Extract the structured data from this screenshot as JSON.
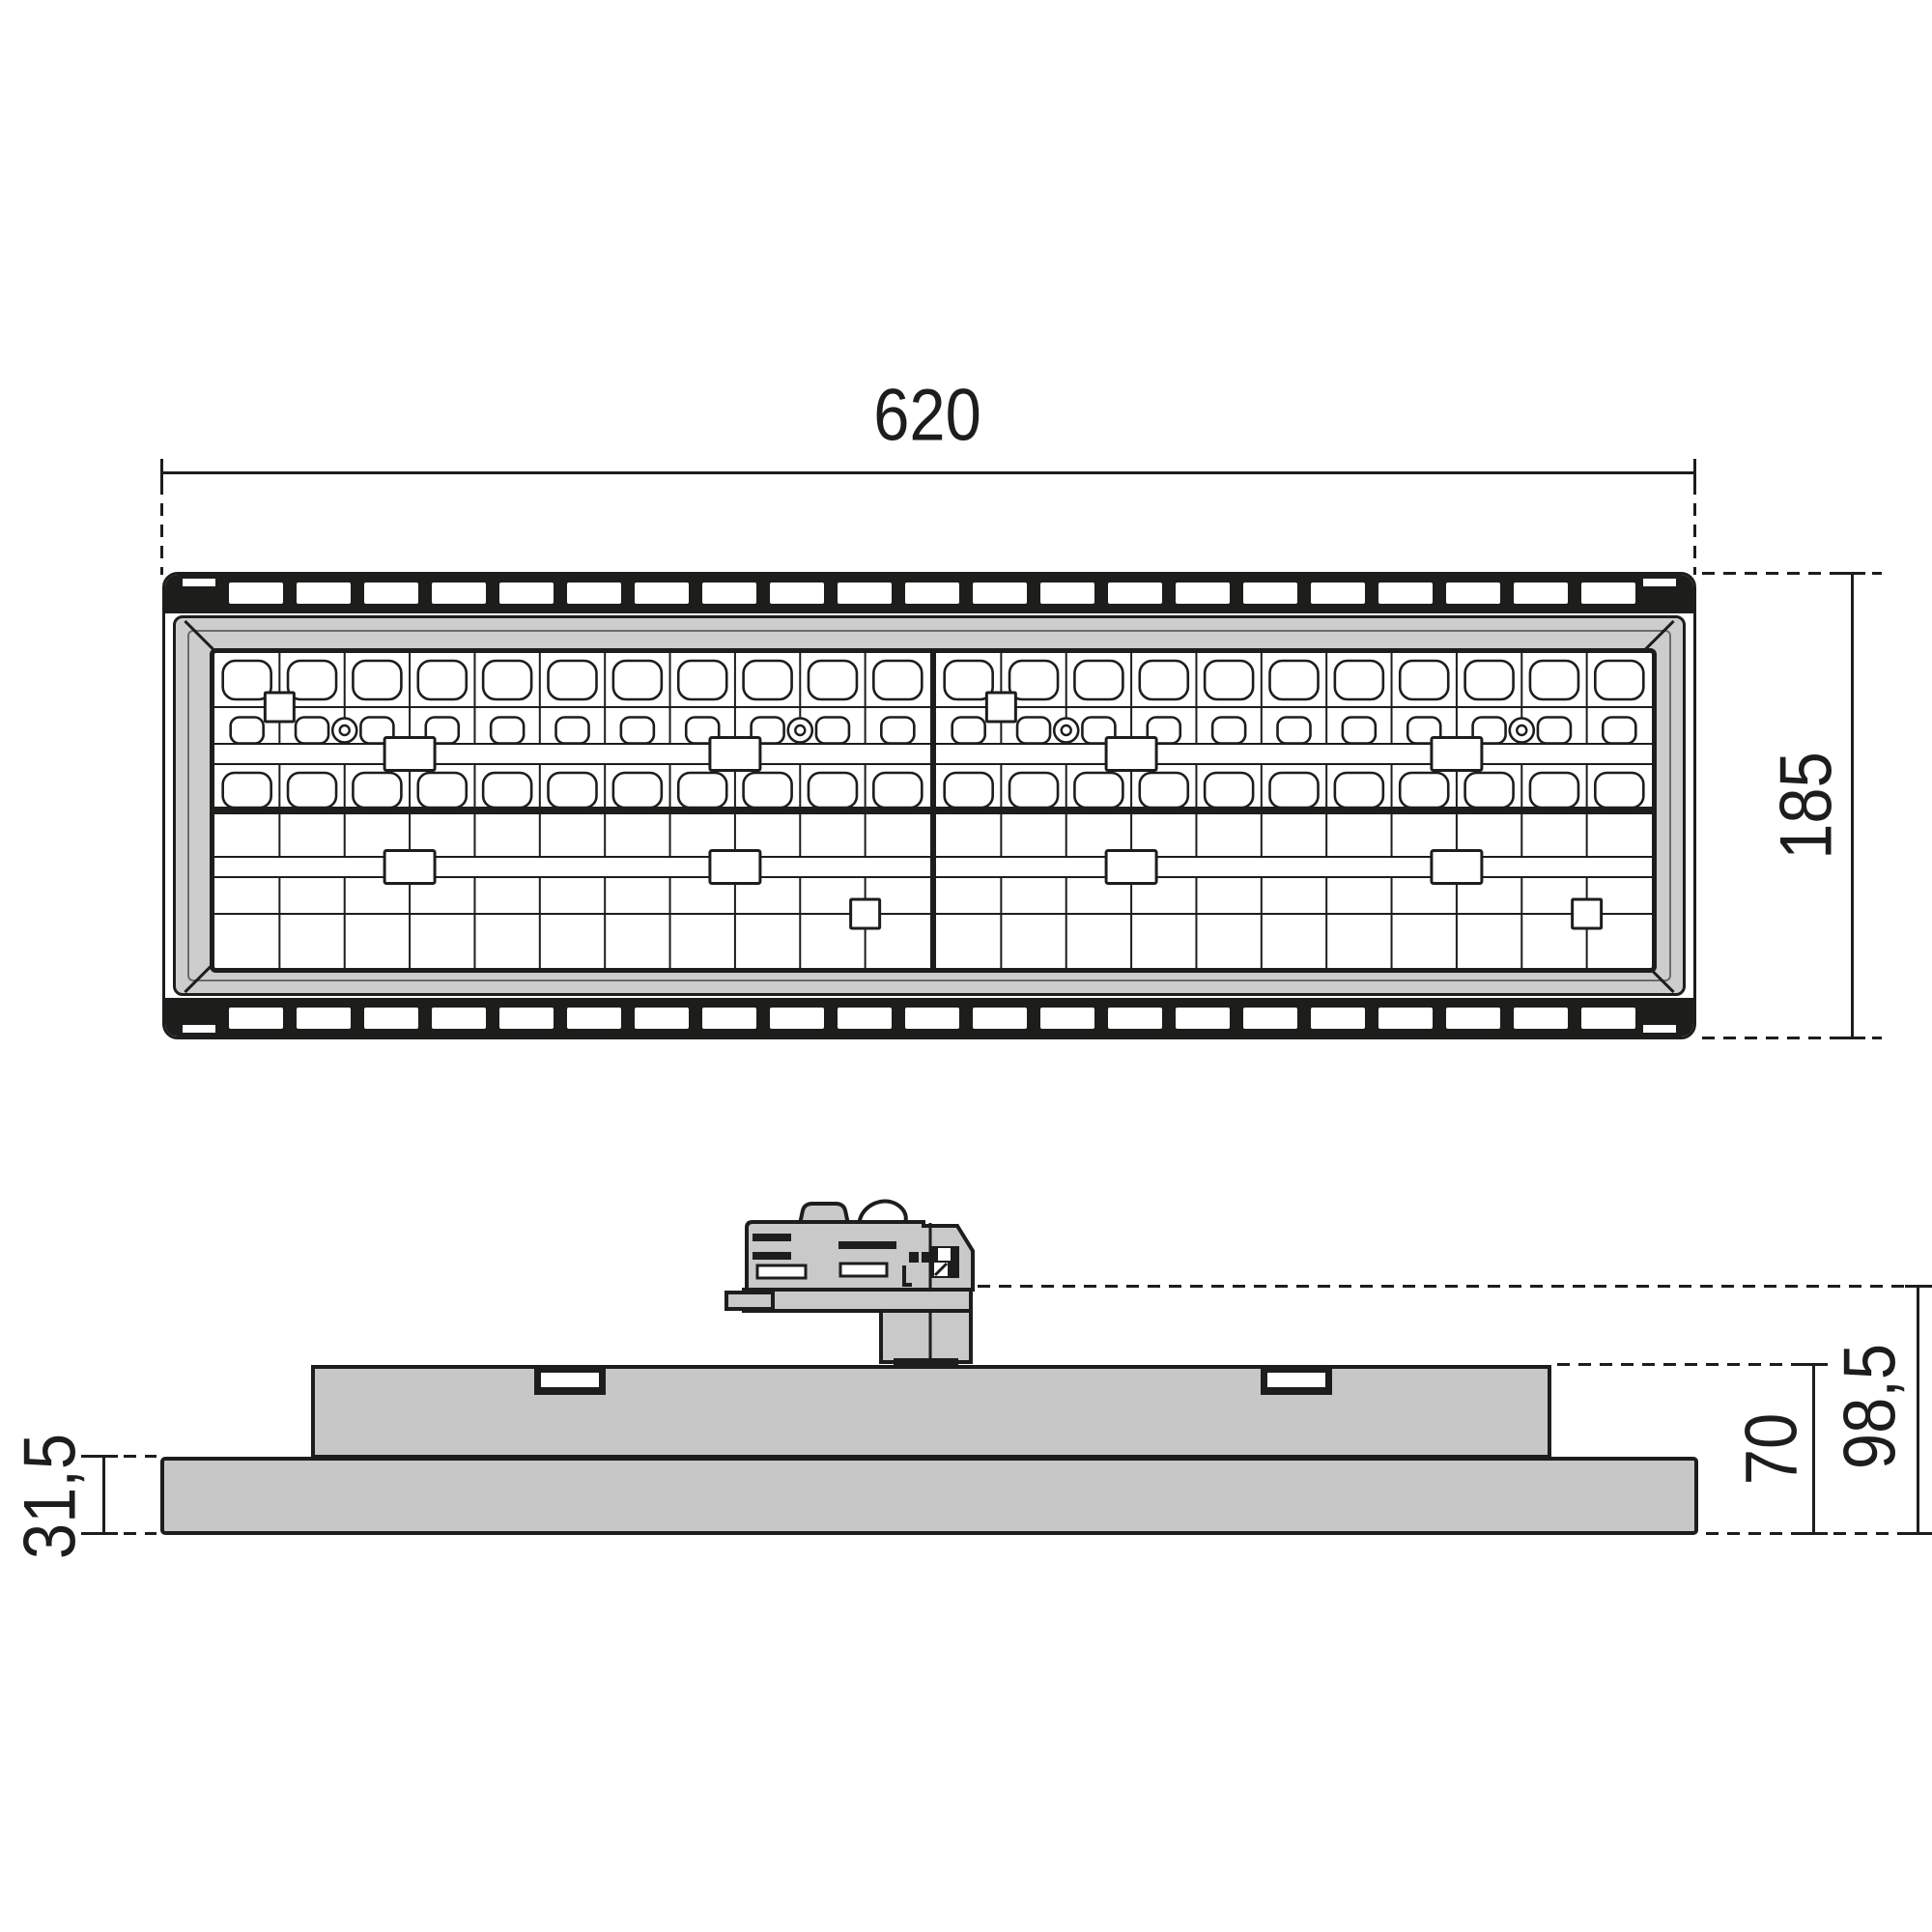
{
  "drawing": {
    "kind": "luminaire dimension drawing",
    "views": {
      "top": "plan view",
      "side": "elevation view"
    }
  },
  "dimensions": {
    "width": "620",
    "depth": "185",
    "base_height": "31,5",
    "body_height": "70",
    "total_height": "98,5"
  },
  "led_grid": {
    "module_grid": {
      "cols": 2,
      "rows": 2
    },
    "columns_per_module": 11,
    "row_pattern": [
      "large",
      "small",
      "rail",
      "large"
    ],
    "screw_columns": [
      2,
      9
    ],
    "pad_columns": [
      3,
      8
    ],
    "heatsink_slots_per_band": 21
  },
  "colors": {
    "line": "#1d1d1b",
    "bezel_gray": "#cdcdcd",
    "body_gray": "#c7c7c7",
    "adapter_gray": "#c9c9c9",
    "panel_white": "#ffffff"
  }
}
